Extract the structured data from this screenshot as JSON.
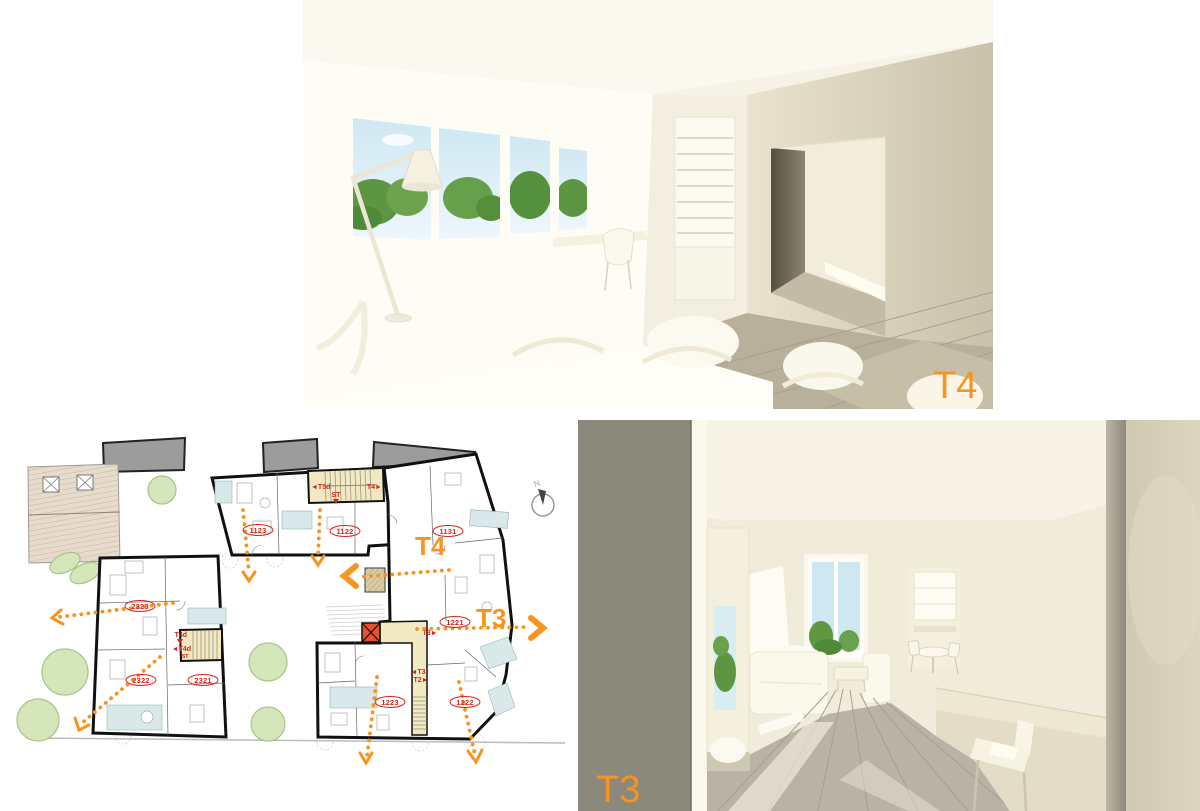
{
  "board": {
    "background": "#ffffff"
  },
  "colors": {
    "accent_orange": "#F7941E",
    "label_red": "#D3271B",
    "stair_yellow": "#F2E9C3",
    "wetroom_blue": "#D9E8E9",
    "neighbor_gray": "#9C9C9C",
    "roof_beige": "#E6DACB",
    "tree_green": "#D3E5BA"
  },
  "top_render": {
    "tag": "T4"
  },
  "bottom_render": {
    "tag": "T3"
  },
  "plan": {
    "compass": "N",
    "zone_t4": "T4",
    "zone_t3": "T3",
    "apartments": [
      {
        "number": "1123"
      },
      {
        "number": "1122"
      },
      {
        "number": "1131"
      },
      {
        "number": "2323"
      },
      {
        "number": "2322"
      },
      {
        "number": "2321"
      },
      {
        "number": "1221"
      },
      {
        "number": "1223"
      },
      {
        "number": "1222"
      }
    ],
    "stairs": {
      "core1_left": "◄T5d",
      "core1_right": "T4►",
      "core1_st": "ST",
      "core2_top": "T4d",
      "core2_mid": "◄T4d",
      "core2_st": "ST",
      "core3_top": "T3►",
      "core3_mid": "◄T3",
      "core3_bottom": "T2►"
    }
  }
}
